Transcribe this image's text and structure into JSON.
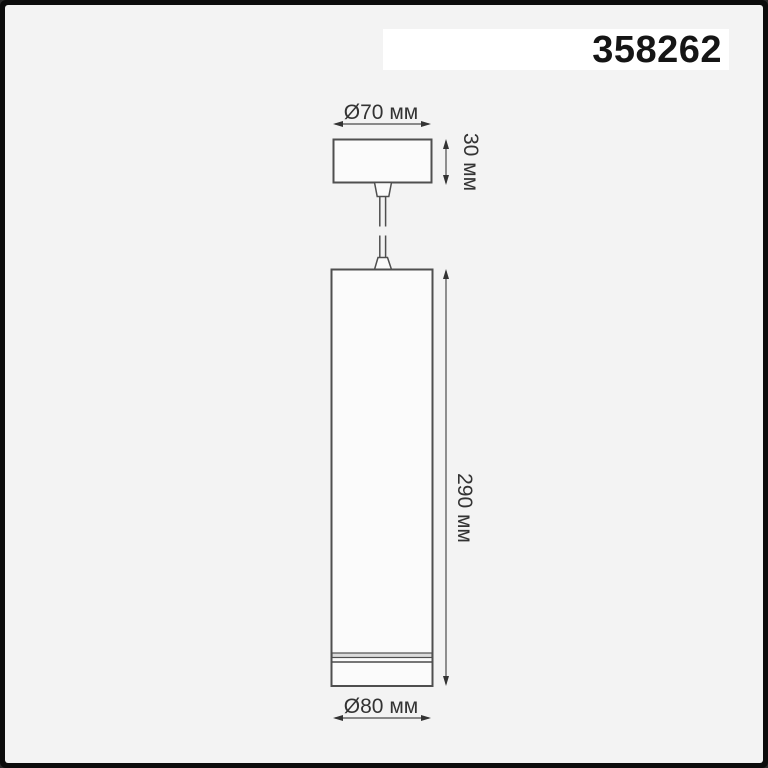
{
  "product_code": "358262",
  "drawing": {
    "description": "pendant-cylinder-luminaire-technical-drawing",
    "dimensions": {
      "canopy_diameter": "Ø70 мм",
      "canopy_height": "30 мм",
      "body_length": "290 мм",
      "body_diameter": "Ø80 мм"
    }
  },
  "colors": {
    "frame": "#0c0c0c",
    "background": "#f3f3f3",
    "code_strip": "#ffffff",
    "line": "#4f4f4f",
    "label_text": "#333333"
  }
}
